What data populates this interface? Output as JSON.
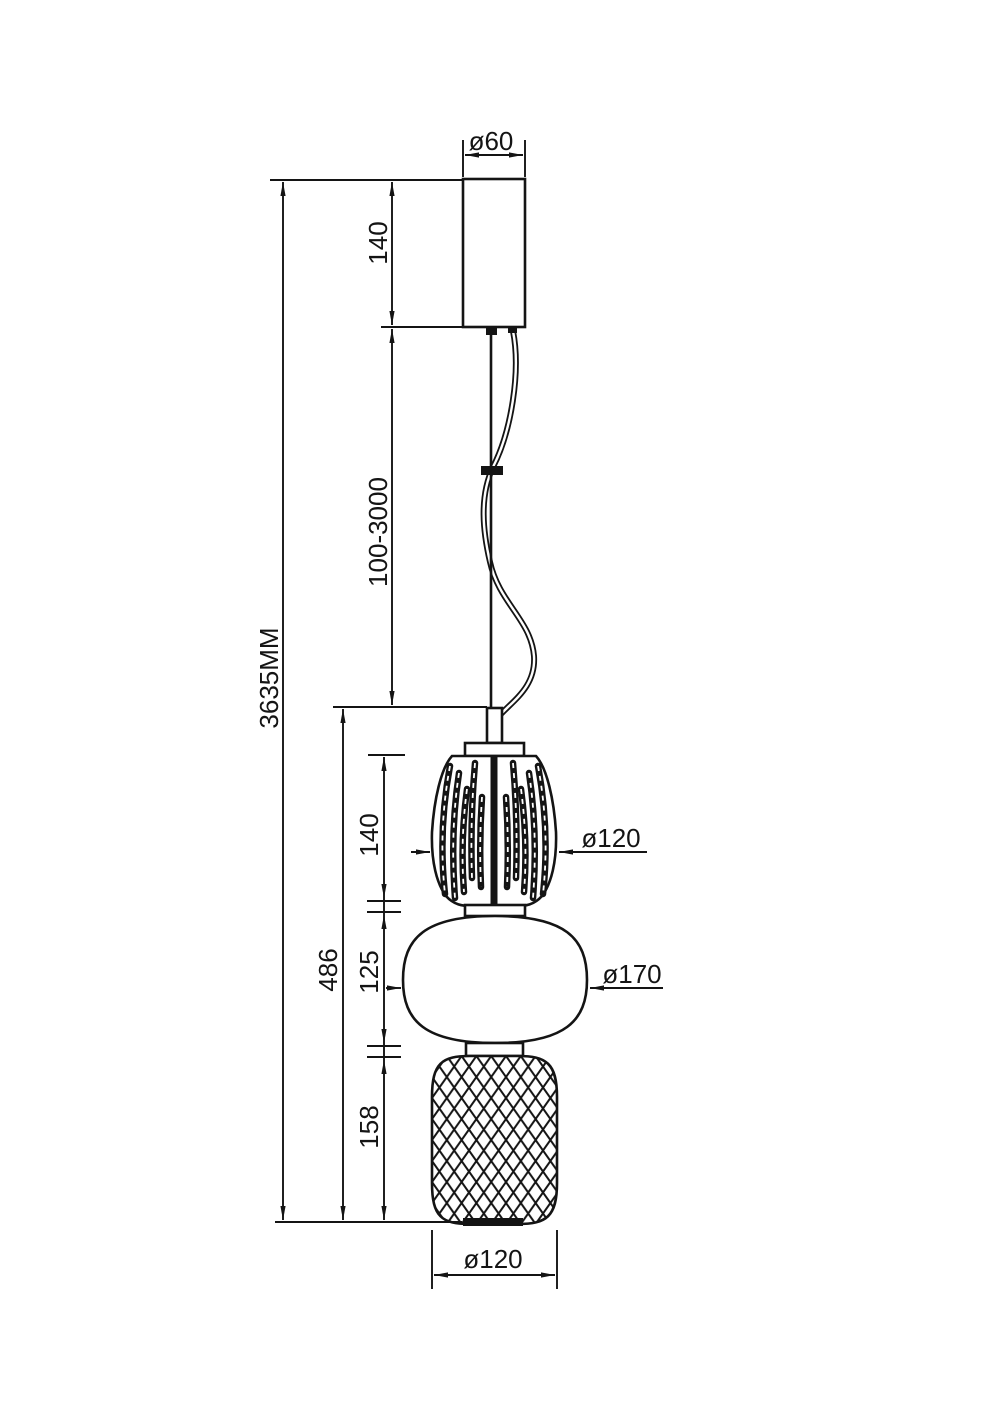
{
  "drawing": {
    "kind": "pendant-lamp-dimension-drawing",
    "line_color": "#141414",
    "background_color": "#ffffff",
    "dimensions": {
      "canopy_diameter": "ø60",
      "canopy_height": "140",
      "suspension_length": "100-3000",
      "overall_height": "3635MM",
      "fixture_height": "486",
      "top_shade_height": "140",
      "middle_shade_height": "125",
      "bottom_shade_height": "158",
      "top_shade_diameter": "ø120",
      "middle_shade_diameter": "ø170",
      "bottom_shade_diameter": "ø120"
    }
  }
}
